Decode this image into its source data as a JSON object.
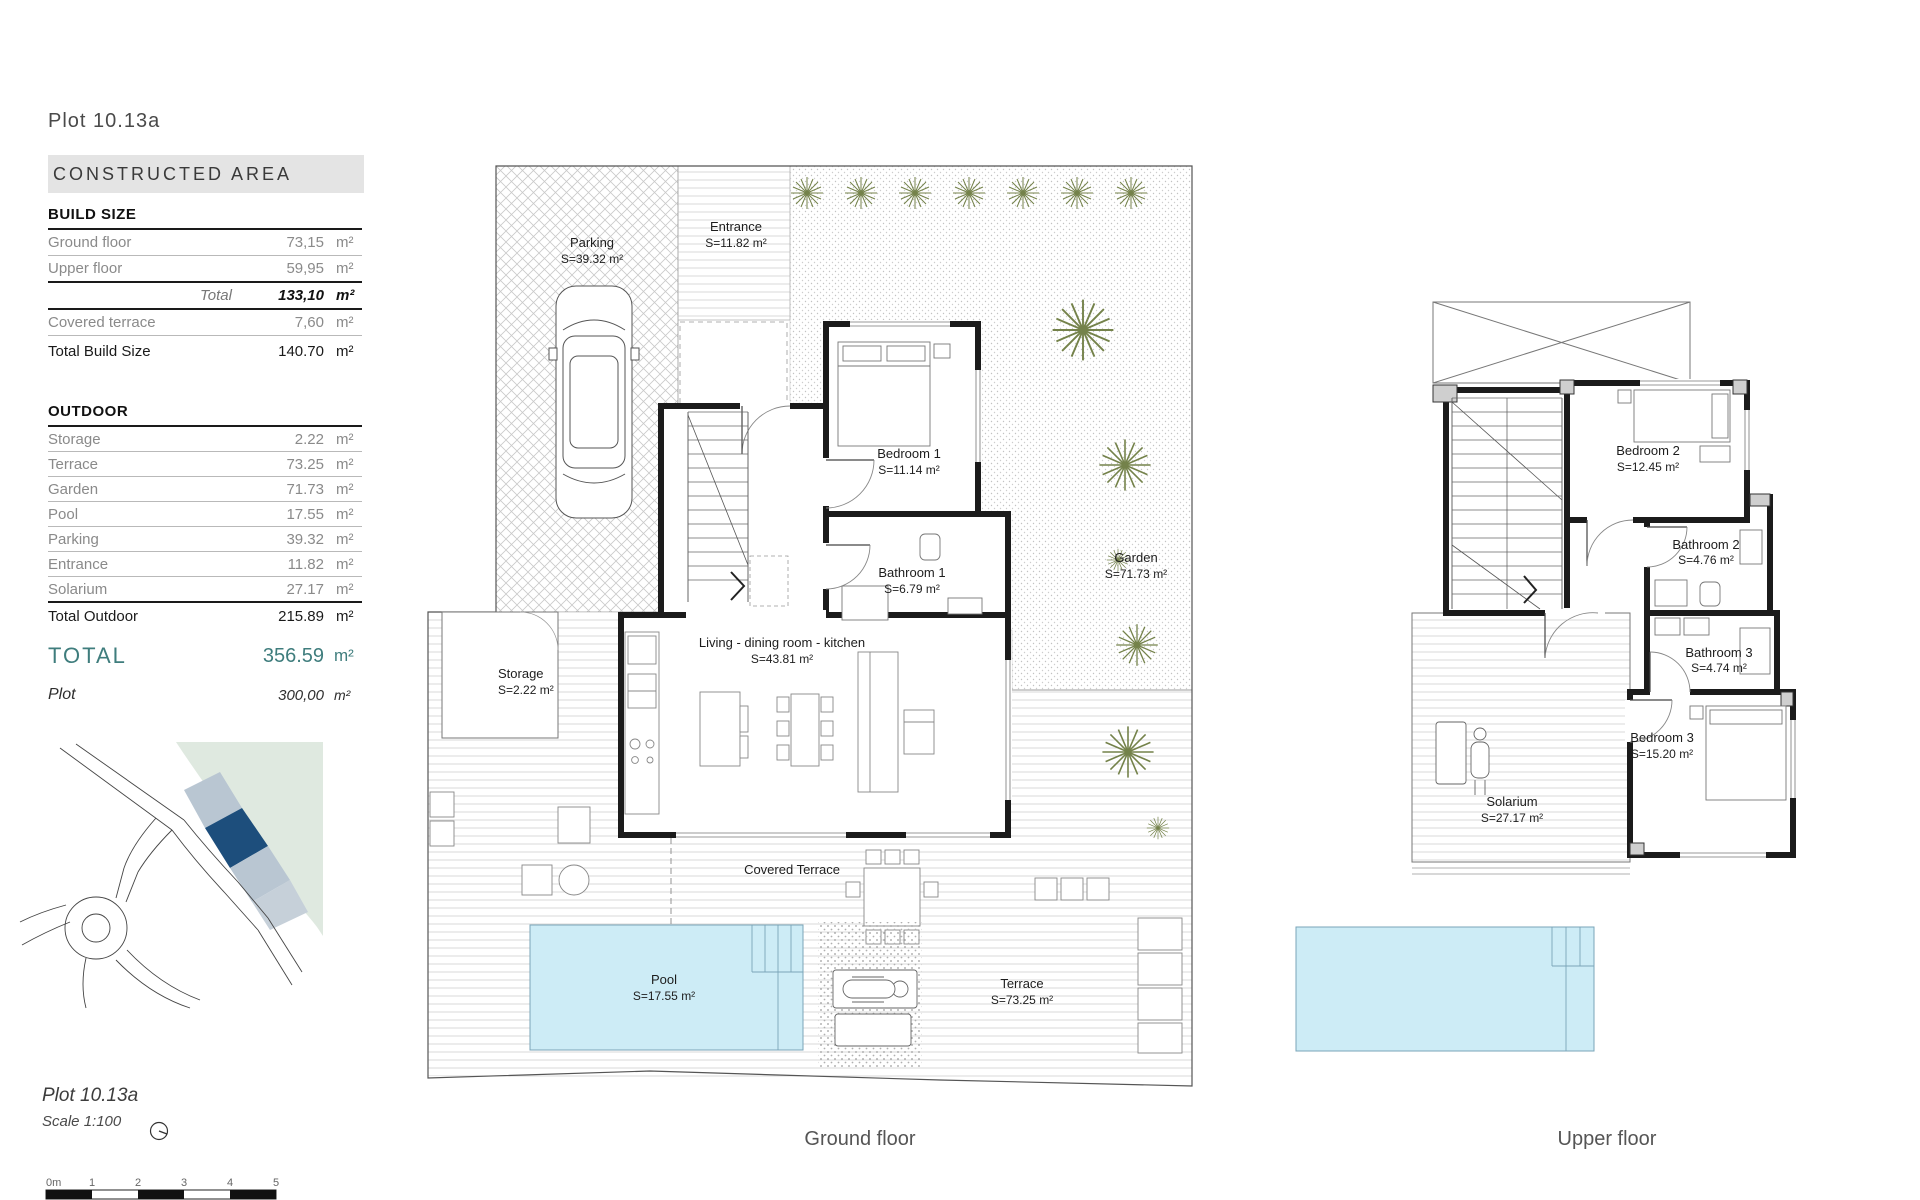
{
  "colors": {
    "accent_teal": "#3f7d7d",
    "pool_blue": "#cdecf6",
    "map_green": "#dfe9e0",
    "map_plot_light": "#b9c6d2",
    "map_plot_selected": "#1d4e7c",
    "plant_green": "#74824a"
  },
  "header": {
    "plot_title": "Plot 10.13a",
    "section_title": "CONSTRUCTED AREA"
  },
  "build_size": {
    "title": "BUILD SIZE",
    "rows": [
      {
        "label": "Ground floor",
        "value": "73,15",
        "unit": "m²"
      },
      {
        "label": "Upper floor",
        "value": "59,95",
        "unit": "m²"
      }
    ],
    "total": {
      "label": "Total",
      "value": "133,10",
      "unit": "m²"
    },
    "covered": {
      "label": "Covered terrace",
      "value": "7,60",
      "unit": "m²"
    },
    "total_build": {
      "label": "Total Build Size",
      "value": "140.70",
      "unit": "m²"
    }
  },
  "outdoor": {
    "title": "OUTDOOR",
    "rows": [
      {
        "label": "Storage",
        "value": "2.22",
        "unit": "m²"
      },
      {
        "label": "Terrace",
        "value": "73.25",
        "unit": "m²"
      },
      {
        "label": "Garden",
        "value": "71.73",
        "unit": "m²"
      },
      {
        "label": "Pool",
        "value": "17.55",
        "unit": "m²"
      },
      {
        "label": "Parking",
        "value": "39.32",
        "unit": "m²"
      },
      {
        "label": "Entrance",
        "value": "11.82",
        "unit": "m²"
      },
      {
        "label": "Solarium",
        "value": "27.17",
        "unit": "m²"
      }
    ],
    "total": {
      "label": "Total Outdoor",
      "value": "215.89",
      "unit": "m²"
    }
  },
  "totals": {
    "total": {
      "label": "TOTAL",
      "value": "356.59",
      "unit": "m²"
    },
    "plot": {
      "label": "Plot",
      "value": "300,00",
      "unit": "m²"
    }
  },
  "footer": {
    "plot_title": "Plot 10.13a",
    "scale_label": "Scale 1:100",
    "scalebar_labels": [
      "0m",
      "1",
      "2",
      "3",
      "4",
      "5"
    ]
  },
  "ground_floor": {
    "caption": "Ground floor",
    "rooms": {
      "parking": {
        "name": "Parking",
        "area": "S=39.32 m²"
      },
      "entrance": {
        "name": "Entrance",
        "area": "S=11.82 m²"
      },
      "garden": {
        "name": "Garden",
        "area": "S=71.73 m²"
      },
      "bedroom1": {
        "name": "Bedroom 1",
        "area": "S=11.14 m²"
      },
      "bathroom1": {
        "name": "Bathroom 1",
        "area": "S=6.79 m²"
      },
      "living": {
        "name": "Living - dining  room - kitchen",
        "area": "S=43.81 m²"
      },
      "storage": {
        "name": "Storage",
        "area": "S=2.22 m²"
      },
      "covered_terrace": {
        "name": "Covered Terrace"
      },
      "pool": {
        "name": "Pool",
        "area": "S=17.55 m²"
      },
      "terrace": {
        "name": "Terrace",
        "area": "S=73.25 m²"
      }
    }
  },
  "upper_floor": {
    "caption": "Upper floor",
    "rooms": {
      "bedroom2": {
        "name": "Bedroom 2",
        "area": "S=12.45 m²"
      },
      "bathroom2": {
        "name": "Bathroom 2",
        "area": "S=4.76 m²"
      },
      "bathroom3": {
        "name": "Bathroom 3",
        "area": "S=4.74 m²"
      },
      "bedroom3": {
        "name": "Bedroom 3",
        "area": "S=15.20 m²"
      },
      "solarium": {
        "name": "Solarium",
        "area": "S=27.17 m²"
      }
    }
  }
}
